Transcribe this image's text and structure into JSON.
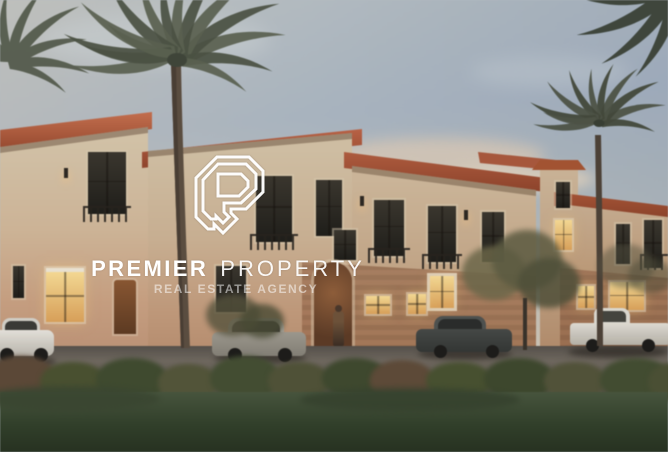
{
  "image": {
    "alt": "Twilight rendering of a row of beige Mediterranean-style townhouses with terracotta tile roofs and lit windows, tall date palm trees, cars parked along the street, green hedges and a dark lawn in the foreground"
  },
  "watermark": {
    "logo_icon": "premier-property-monogram",
    "brand_primary": "PREMIER",
    "brand_secondary": "PROPERTY",
    "tagline": "REAL ESTATE AGENCY",
    "text_color": "#ffffff"
  },
  "palette": {
    "sky_top": "#a9b4c0",
    "sky_horizon": "#e6d6b8",
    "wall_light": "#cdbca0",
    "wall_warm": "#c39a7b",
    "brick_warm": "#96634497",
    "roof_terracotta": "#a85538",
    "window_lit": "#eac177",
    "palm_frond": "#4f5547",
    "palm_trunk": "#5b4d3f",
    "hedge_green": "#49503a",
    "lawn_green": "#37452e",
    "road_gray": "#6e675e",
    "car_white": "#d9d6cf",
    "car_gray": "#8f8a7f",
    "car_dark": "#3d403e"
  }
}
